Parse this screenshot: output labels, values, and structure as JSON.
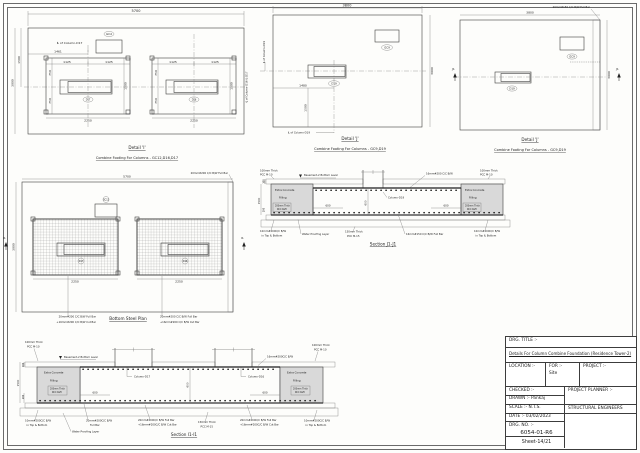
{
  "detail_i": {
    "title": "Detail 'I'",
    "subtitle": "Combine Footing For Columns - GC12,D16,D17",
    "cl_d17": "℄ of Column-D17",
    "cl_right": "℄ of Column-D16 & D17",
    "gc12": "GC12",
    "d17": "D17",
    "d16": "D16",
    "dims": {
      "w": "5700",
      "h": "3000",
      "t": "1500",
      "off": "1461",
      "q": "1125",
      "e": "750",
      "fh": "1500",
      "fw": "2250"
    }
  },
  "detail_j": {
    "title": "Detail 'J'",
    "subtitle": "Combine Footing For Columns - GC9,D19",
    "cl_d19": "℄ of Column-D19",
    "gc9": "GC9",
    "d19": "D19",
    "dims": {
      "w": "3800",
      "h": "3000",
      "x": "1480",
      "y": "1500"
    }
  },
  "plan_j": {
    "note": "20mm#150 C/C B/W Full Bar",
    "mark": "J1"
  },
  "bsp": {
    "title": "Bottom Steel Plan",
    "note_top": "20mm#200 C/C B/W Full Bar",
    "note_full": "20mm#200 C/C B/W Full Bar",
    "note_cut": "+16mm#200 C/C B/W Cut Bar",
    "mark": "I1",
    "dims": {
      "w": "5700",
      "h": "3000",
      "fw": "2250"
    }
  },
  "sec": {
    "pcc1": "100mm Thick",
    "pcc2": "PCC M-10",
    "basement": "Basement-2 Bottom Level",
    "extra": "Extra Concrete",
    "filling": "Filling",
    "raft1": "200mm Thick",
    "raft2": "RCC Raft",
    "tb1": "10mm#200C/C B/W",
    "tb2": "in Top & Bottom",
    "wp": "Water Proofing Layer",
    "pccb1": "150mm Thick",
    "pccb2": "PCC M-15",
    "d600": "600",
    "d1500": "1500",
    "d100": "100",
    "d200": "200"
  },
  "sec_j1": {
    "title": "Section J1-J1",
    "rebar_top": "16mm#200 C/C B/W",
    "rebar_bottom": "16mm#150 C/C B/W Full Bar",
    "column": "Column-D19"
  },
  "sec_i1": {
    "title": "Section I1-I1",
    "rebar_top": "16mm#200C/C B/W",
    "col_left": "Column-D17",
    "col_right": "Column-D16",
    "bar1": "20mm#200C/C B/W",
    "bar2": "Full Bar",
    "barfull": "20mm#200C/C B/W Full Bar",
    "barcut": "+16mm#200C/C B/W Cut Bar"
  },
  "tb": {
    "drg_title_label": "DRG. TITLE :-",
    "drg_title": "Details For Column Combine Foundation (Residence Tower-2)",
    "location": "LOCATION :-",
    "for_label": "FOR :-",
    "for_value": "Site",
    "project": "PROJECT :-",
    "checked": "CHECKED :-",
    "drawn_label": "DRAWN :-",
    "drawn_value": "Pankaj",
    "scale_label": "SCALE :-",
    "scale_value": "N.T.S.",
    "date_label": "DATE :-",
    "date_value": "03/02/2023",
    "planner": "PROJECT PLANNER :-",
    "engineers": "STRUCTURAL ENGINEERS",
    "drg_no_label": "DRG. NO. :-",
    "drg_no": "6054-01-R6",
    "sheet": "Sheet-14/21"
  }
}
